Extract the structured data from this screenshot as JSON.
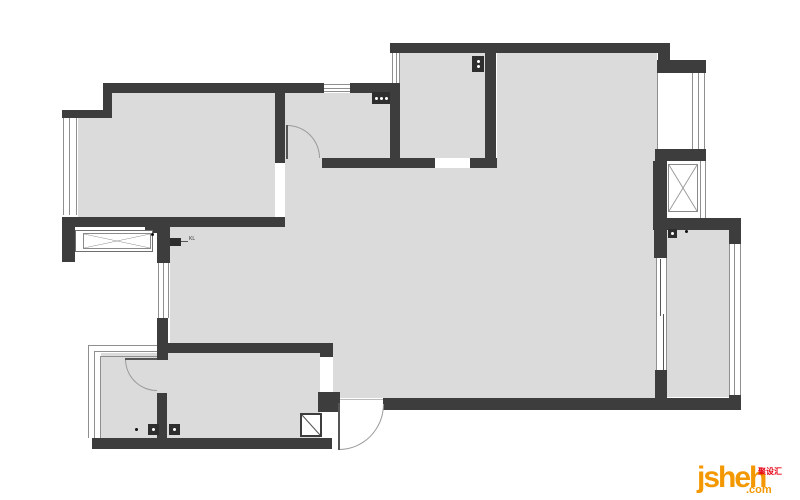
{
  "watermark": {
    "brand": "jsheh",
    "tld": ".com",
    "cjk": "聚设汇",
    "brand_color": "#f39800",
    "cjk_color": "#e60012"
  },
  "plan": {
    "wall_color": "#3d3d3d",
    "floor_color": "#dbdbdb",
    "line_color": "#8f8f8f",
    "floors": [
      {
        "x": 112,
        "y": 93,
        "w": 173,
        "h": 25,
        "n": "floor-bedroom1-upper"
      },
      {
        "x": 78,
        "y": 118,
        "w": 207,
        "h": 99,
        "n": "floor-bedroom1"
      },
      {
        "x": 285,
        "y": 93,
        "w": 105,
        "h": 75,
        "n": "floor-bath-top"
      },
      {
        "x": 400,
        "y": 53,
        "w": 85,
        "h": 105,
        "n": "floor-room-top-middle"
      },
      {
        "x": 497,
        "y": 53,
        "w": 160,
        "h": 345,
        "n": "floor-living-right"
      },
      {
        "x": 285,
        "y": 168,
        "w": 212,
        "h": 230,
        "n": "floor-living-center"
      },
      {
        "x": 170,
        "y": 227,
        "w": 115,
        "h": 116,
        "n": "floor-hallway"
      },
      {
        "x": 101,
        "y": 353,
        "w": 219,
        "h": 85,
        "n": "floor-bedroom2-bath"
      },
      {
        "x": 667,
        "y": 230,
        "w": 62,
        "h": 167,
        "n": "floor-kitchen"
      }
    ],
    "white_gaps": [
      {
        "x": 275,
        "y": 163,
        "w": 10,
        "h": 54,
        "n": "door-opening-bedroom1"
      },
      {
        "x": 320,
        "y": 357,
        "w": 13,
        "h": 35,
        "n": "door-opening-bedroom2"
      }
    ],
    "lines": [
      {
        "x": 324,
        "y": 84,
        "w": 26,
        "h": 1,
        "n": "window-line"
      },
      {
        "x": 324,
        "y": 88,
        "w": 26,
        "h": 1,
        "n": "window-line"
      },
      {
        "x": 324,
        "y": 91,
        "w": 26,
        "h": 1,
        "n": "window-line"
      },
      {
        "x": 63,
        "y": 118,
        "w": 1,
        "h": 97,
        "n": "window-line"
      },
      {
        "x": 69,
        "y": 118,
        "w": 1,
        "h": 97,
        "n": "window-line"
      },
      {
        "x": 76,
        "y": 118,
        "w": 1,
        "h": 97,
        "n": "window-line"
      },
      {
        "x": 392,
        "y": 53,
        "w": 1,
        "h": 30,
        "n": "window-line"
      },
      {
        "x": 396,
        "y": 53,
        "w": 1,
        "h": 30,
        "n": "window-line"
      },
      {
        "x": 399,
        "y": 53,
        "w": 1,
        "h": 30,
        "n": "window-line"
      },
      {
        "x": 158,
        "y": 263,
        "w": 1,
        "h": 55,
        "n": "window-line"
      },
      {
        "x": 163,
        "y": 263,
        "w": 1,
        "h": 55,
        "n": "window-line"
      },
      {
        "x": 168,
        "y": 263,
        "w": 1,
        "h": 55,
        "n": "window-line"
      },
      {
        "x": 657,
        "y": 73,
        "w": 1,
        "h": 76,
        "n": "bay-window-line"
      },
      {
        "x": 692,
        "y": 73,
        "w": 1,
        "h": 76,
        "n": "bay-window-line"
      },
      {
        "x": 698,
        "y": 73,
        "w": 1,
        "h": 76,
        "n": "bay-window-line"
      },
      {
        "x": 704,
        "y": 73,
        "w": 1,
        "h": 76,
        "n": "bay-window-line"
      },
      {
        "x": 700,
        "y": 161,
        "w": 1,
        "h": 57,
        "n": "bay-window-line"
      },
      {
        "x": 705,
        "y": 161,
        "w": 1,
        "h": 57,
        "n": "bay-window-line"
      },
      {
        "x": 729,
        "y": 244,
        "w": 1,
        "h": 153,
        "n": "window-line"
      },
      {
        "x": 734,
        "y": 244,
        "w": 1,
        "h": 153,
        "n": "window-line"
      },
      {
        "x": 740,
        "y": 244,
        "w": 1,
        "h": 153,
        "n": "window-line"
      },
      {
        "x": 88,
        "y": 345,
        "w": 1,
        "h": 93,
        "n": "bay-line"
      },
      {
        "x": 94,
        "y": 351,
        "w": 1,
        "h": 87,
        "n": "bay-line"
      },
      {
        "x": 100,
        "y": 356,
        "w": 1,
        "h": 82,
        "n": "bay-line"
      },
      {
        "x": 88,
        "y": 345,
        "w": 69,
        "h": 1,
        "n": "bay-line"
      },
      {
        "x": 94,
        "y": 351,
        "w": 63,
        "h": 1,
        "n": "bay-line"
      },
      {
        "x": 100,
        "y": 356,
        "w": 57,
        "h": 1,
        "n": "bay-line"
      },
      {
        "x": 656,
        "y": 258,
        "w": 1,
        "h": 112,
        "n": "sliding-door-frame"
      },
      {
        "x": 666,
        "y": 258,
        "w": 1,
        "h": 112,
        "n": "sliding-door-frame"
      },
      {
        "x": 660,
        "y": 259,
        "w": 1,
        "h": 57,
        "c": "#555",
        "n": "sliding-door-leaf"
      },
      {
        "x": 663,
        "y": 314,
        "w": 1,
        "h": 57,
        "c": "#555",
        "n": "sliding-door-leaf"
      },
      {
        "x": 340,
        "y": 399,
        "w": 43,
        "h": 1,
        "c": "#bbb",
        "n": "entrance-threshold"
      },
      {
        "x": 180,
        "y": 241,
        "w": 8,
        "h": 1,
        "c": "#555",
        "n": "kl-arrow"
      }
    ],
    "walls": [
      {
        "x": 103,
        "y": 83,
        "w": 221,
        "h": 10
      },
      {
        "x": 350,
        "y": 83,
        "w": 50,
        "h": 10
      },
      {
        "x": 103,
        "y": 83,
        "w": 9,
        "h": 30
      },
      {
        "x": 62,
        "y": 110,
        "w": 50,
        "h": 8
      },
      {
        "x": 62,
        "y": 217,
        "w": 223,
        "h": 10
      },
      {
        "x": 62,
        "y": 227,
        "w": 13,
        "h": 35
      },
      {
        "x": 275,
        "y": 93,
        "w": 10,
        "h": 70
      },
      {
        "x": 322,
        "y": 158,
        "w": 78,
        "h": 10
      },
      {
        "x": 390,
        "y": 93,
        "w": 10,
        "h": 75
      },
      {
        "x": 390,
        "y": 43,
        "w": 275,
        "h": 10
      },
      {
        "x": 485,
        "y": 53,
        "w": 11,
        "h": 115
      },
      {
        "x": 390,
        "y": 158,
        "w": 45,
        "h": 10
      },
      {
        "x": 470,
        "y": 158,
        "w": 27,
        "h": 10
      },
      {
        "x": 658,
        "y": 43,
        "w": 12,
        "h": 20
      },
      {
        "x": 657,
        "y": 60,
        "w": 49,
        "h": 13
      },
      {
        "x": 655,
        "y": 149,
        "w": 51,
        "h": 12
      },
      {
        "x": 653,
        "y": 161,
        "w": 14,
        "h": 66
      },
      {
        "x": 653,
        "y": 218,
        "w": 88,
        "h": 12
      },
      {
        "x": 654,
        "y": 230,
        "w": 13,
        "h": 28
      },
      {
        "x": 729,
        "y": 230,
        "w": 12,
        "h": 14
      },
      {
        "x": 655,
        "y": 370,
        "w": 12,
        "h": 28
      },
      {
        "x": 383,
        "y": 398,
        "w": 358,
        "h": 12
      },
      {
        "x": 729,
        "y": 395,
        "w": 12,
        "h": 15
      },
      {
        "x": 318,
        "y": 392,
        "w": 22,
        "h": 20
      },
      {
        "x": 157,
        "y": 343,
        "w": 176,
        "h": 10
      },
      {
        "x": 320,
        "y": 343,
        "w": 13,
        "h": 14
      },
      {
        "x": 92,
        "y": 438,
        "w": 240,
        "h": 11
      },
      {
        "x": 157,
        "y": 318,
        "w": 11,
        "h": 42
      },
      {
        "x": 157,
        "y": 393,
        "w": 10,
        "h": 45
      },
      {
        "x": 157,
        "y": 227,
        "w": 13,
        "h": 36
      },
      {
        "x": 145,
        "y": 227,
        "w": 12,
        "h": 6
      }
    ],
    "oboxes": [
      {
        "x": 75,
        "y": 230,
        "w": 78,
        "h": 22,
        "n": "bay-box-outer"
      }
    ],
    "xboxes": [
      {
        "x": 83,
        "y": 233,
        "w": 68,
        "h": 16,
        "n": "ac-platform-left"
      },
      {
        "x": 668,
        "y": 164,
        "w": 30,
        "h": 48,
        "n": "ac-platform-right"
      }
    ],
    "diagboxes": [
      {
        "x": 300,
        "y": 413,
        "w": 22,
        "h": 24,
        "n": "corner-column"
      }
    ],
    "doors": [
      {
        "n": "door-bath-top",
        "arc": {
          "x": 287,
          "y": 125,
          "w": 33,
          "h": 33,
          "corner": "tr"
        },
        "leaf": {
          "x": 286,
          "y": 125,
          "w": 2,
          "h": 34
        }
      },
      {
        "n": "door-bath-left",
        "arc": {
          "x": 125,
          "y": 359,
          "w": 32,
          "h": 32,
          "corner": "bl"
        },
        "leaf": {
          "x": 125,
          "y": 358,
          "w": 32,
          "h": 2
        }
      },
      {
        "n": "door-entrance",
        "arc": {
          "x": 339,
          "y": 404,
          "w": 45,
          "h": 46,
          "corner": "br"
        },
        "leaf": {
          "x": 338,
          "y": 403,
          "w": 2,
          "h": 47
        }
      }
    ],
    "symbols": [
      {
        "x": 372,
        "y": 92,
        "w": 18,
        "h": 12,
        "dots": 3,
        "dir": "h",
        "n": "symbol-washer"
      },
      {
        "x": 472,
        "y": 56,
        "w": 12,
        "h": 16,
        "dots": 2,
        "dir": "v",
        "n": "symbol-stove"
      },
      {
        "x": 668,
        "y": 229,
        "w": 9,
        "h": 9,
        "dots": 1,
        "dir": "h",
        "n": "symbol-kitchen-meter"
      },
      {
        "x": 148,
        "y": 424,
        "w": 11,
        "h": 11,
        "dots": 1,
        "dir": "h",
        "n": "symbol-drain-1"
      },
      {
        "x": 169,
        "y": 424,
        "w": 11,
        "h": 11,
        "dots": 1,
        "dir": "h",
        "n": "symbol-drain-2"
      },
      {
        "x": 170,
        "y": 238,
        "w": 11,
        "h": 8,
        "dots": 0,
        "dir": "h",
        "n": "symbol-kl-box"
      }
    ],
    "dots": [
      {
        "x": 135,
        "y": 428,
        "w": 3,
        "h": 3,
        "n": "plan-dot"
      },
      {
        "x": 685,
        "y": 230,
        "w": 3,
        "h": 3,
        "n": "plan-dot"
      },
      {
        "x": 151,
        "y": 233,
        "w": 3,
        "h": 3,
        "n": "plan-dot"
      }
    ],
    "labels": [
      {
        "text": "KL",
        "x": 189,
        "y": 236,
        "n": "label-kl"
      }
    ]
  }
}
